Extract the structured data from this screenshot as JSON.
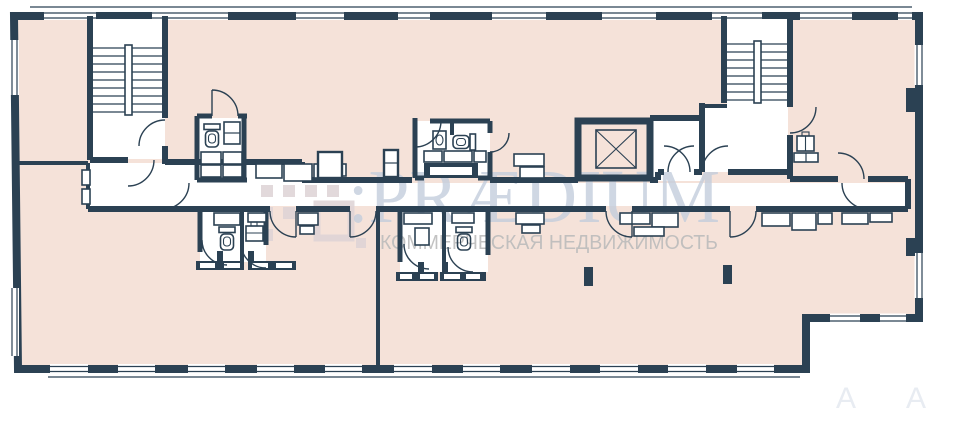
{
  "colors": {
    "page_bg": "#ffffff",
    "wall": "#2b4153",
    "floor": "#f5e2d9",
    "room": "#ffffff",
    "watermark_brand": "#c2cddc",
    "watermark_logo": "#ddd2d5",
    "watermark_tagline": "#bcbcbc",
    "faint_mark": "#e8ecf2"
  },
  "watermark": {
    "logo": "praedium-dots-logo",
    "brand_lockup": ":PRÆDIUM",
    "tagline": "КОММЕРЧЕСКАЯ НЕДВИЖИМОСТЬ",
    "corner_marks": [
      "А",
      "А"
    ]
  },
  "plan": {
    "kind": "floor-plan",
    "features": {
      "stairwells": [
        "stairwell-left",
        "stairwell-right"
      ],
      "elevator": "elevator-shaft",
      "wc_count": 4,
      "door_count": 16,
      "column_count": 2
    }
  }
}
